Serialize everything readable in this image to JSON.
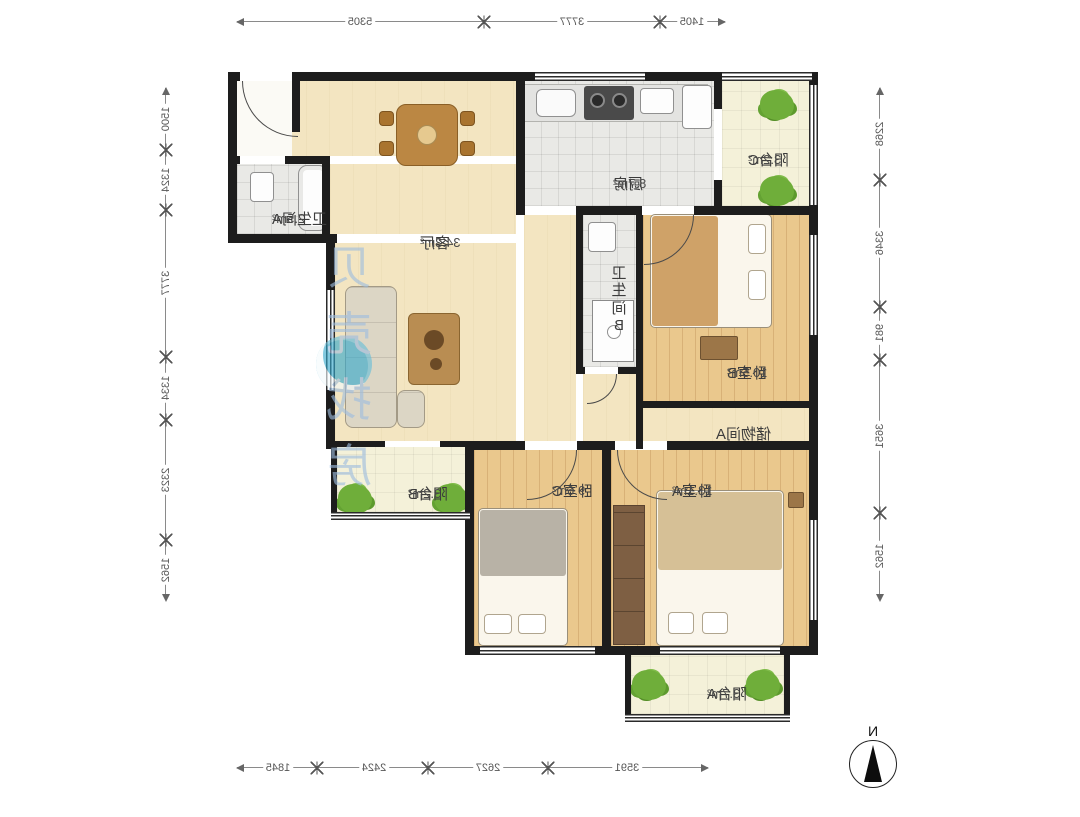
{
  "plan": {
    "rooms": [
      {
        "name": "客厅",
        "area": "34.3m²"
      },
      {
        "name": "厨房",
        "area": "8.7m²"
      },
      {
        "name": "阳台C",
        "area": "3.2m²"
      },
      {
        "name": "卫生间A",
        "area": "2.5m²"
      },
      {
        "name": "卫生间B",
        "area": ""
      },
      {
        "name": "卧室B",
        "area": "10.5m²"
      },
      {
        "name": "储物间A",
        "area": ""
      },
      {
        "name": "卧室C",
        "area": "9.6m²"
      },
      {
        "name": "卧室A",
        "area": "13.1m²"
      },
      {
        "name": "阳台B",
        "area": "3.2m²"
      },
      {
        "name": "阳台A",
        "area": "3.7m²"
      }
    ],
    "dimensions": {
      "top": [
        "5305",
        "3777",
        "1405"
      ],
      "bottom": [
        "1845",
        "2424",
        "2627",
        "3591"
      ],
      "left": [
        "1500",
        "1324",
        "3777",
        "1334",
        "2323",
        "1562"
      ],
      "right": [
        "2268",
        "3346",
        "981",
        "3651",
        "1562"
      ]
    },
    "watermark": "贝壳找房",
    "compass_label": "N",
    "colors": {
      "wall": "#1d1d1d",
      "wood_floor": "#eac88d",
      "tile_floor": "#e9e9e6",
      "living_floor": "#f3e5c1",
      "balcony_floor": "#f4f1d9",
      "plant": "#6fae3a",
      "watermark_text": "#9ebddf",
      "watermark_logo": "#35a9cc",
      "dimension_text": "#555555"
    },
    "note_mirrored": "screenshot is horizontally mirrored"
  }
}
